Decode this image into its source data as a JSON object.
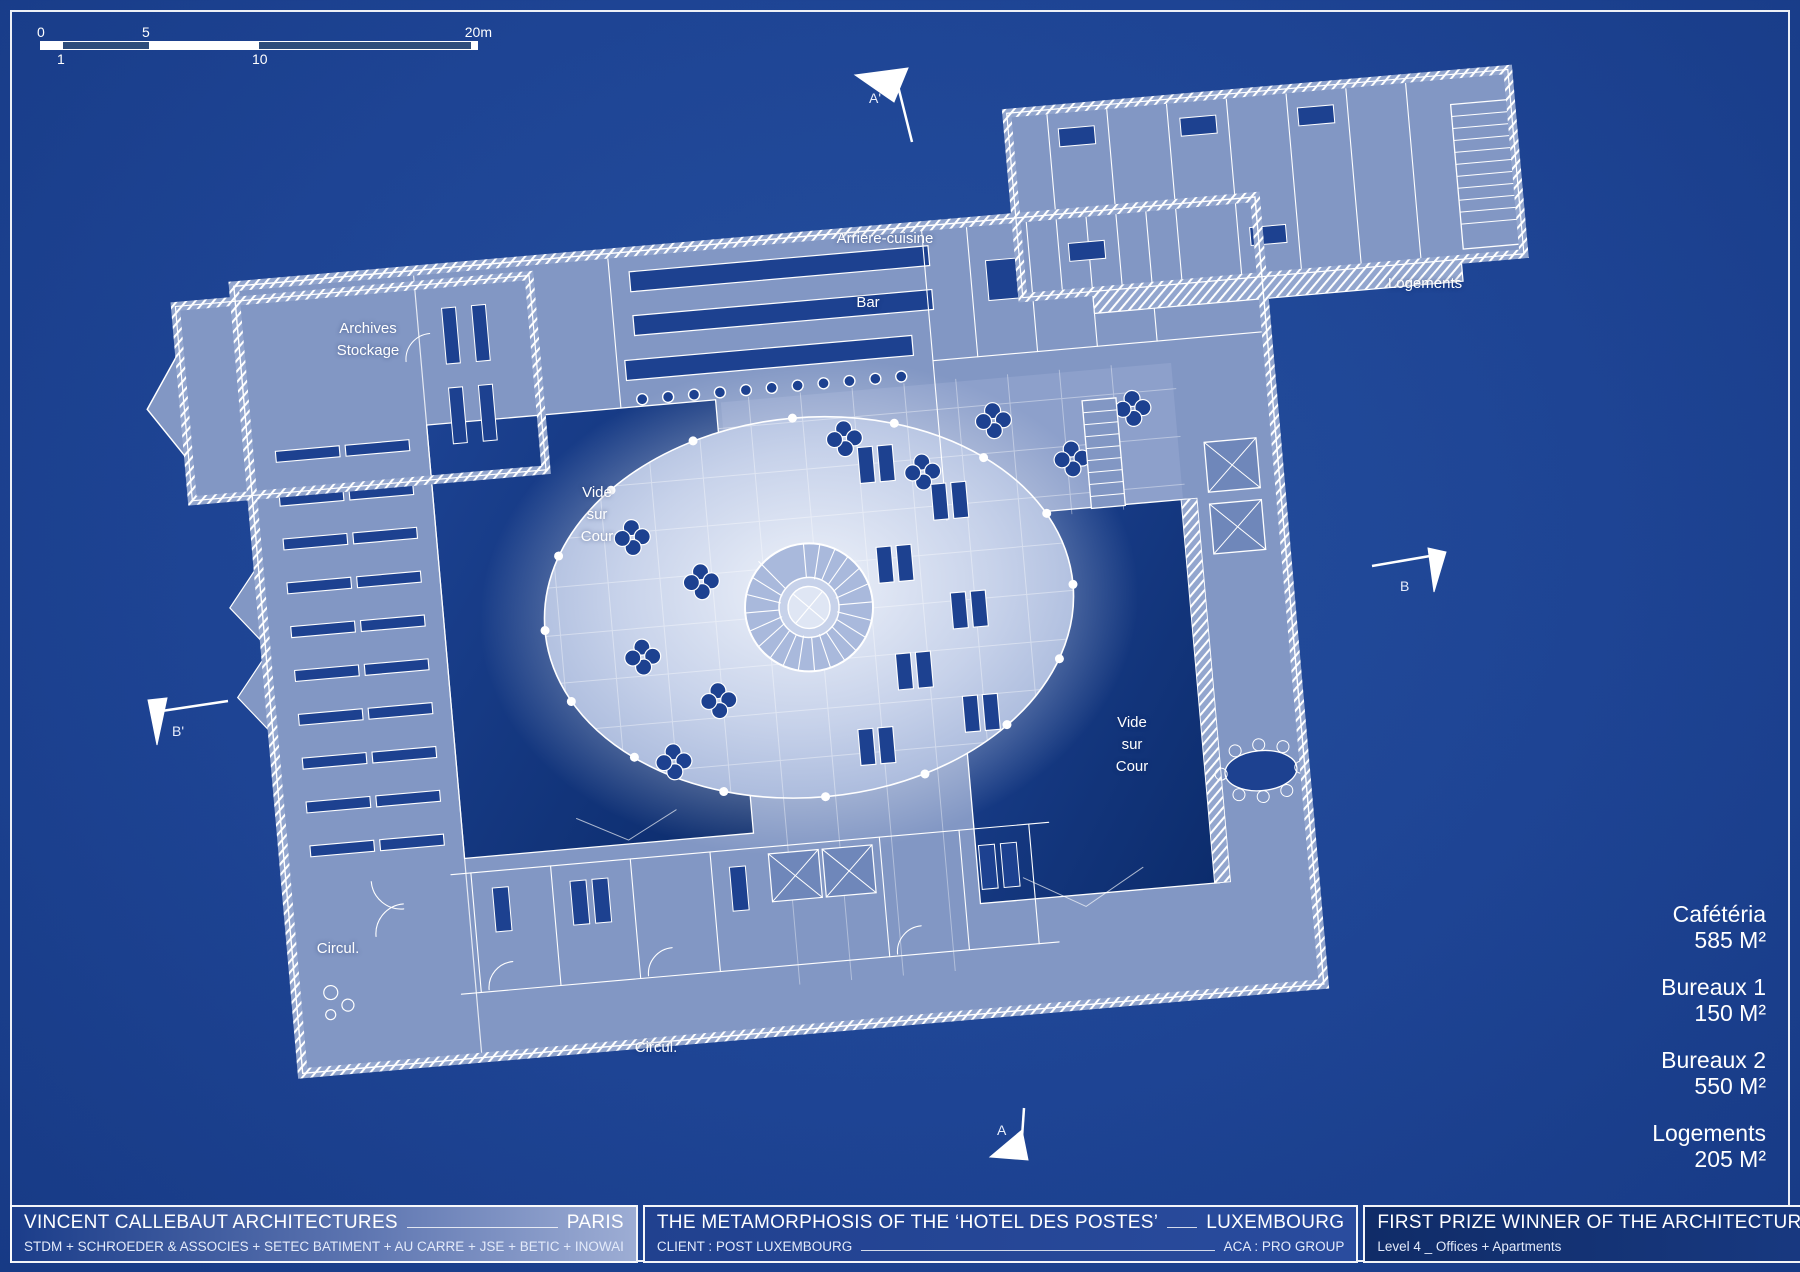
{
  "scale_bar": {
    "top_labels": {
      "zero": "0",
      "five": "5",
      "twenty": "20m"
    },
    "bottom_labels": {
      "one": "1",
      "ten": "10"
    }
  },
  "plan_labels": {
    "arriere_cuisine": "Arriere-cuisine",
    "bar": "Bar",
    "logements": "Logements",
    "archives": "Archives\nStockage",
    "vide_sur_cour_left": "Vide\nsur\nCour",
    "vide_sur_cour_right": "Vide\nsur\nCour",
    "circul_left": "Circul.",
    "circul_bottom": "Circul."
  },
  "section_markers": {
    "a_prime": "A'",
    "b": "B",
    "b_prime": "B'",
    "a": "A"
  },
  "legend": {
    "items": [
      {
        "label": "Cafétéria",
        "area": "585 M²"
      },
      {
        "label": "Bureaux 1",
        "area": "150 M²"
      },
      {
        "label": "Bureaux 2",
        "area": "550 M²"
      },
      {
        "label": "Logements",
        "area": "205 M²"
      }
    ]
  },
  "title_block": {
    "architect": {
      "line1_left": "VINCENT CALLEBAUT ARCHITECTURES",
      "line1_right": "PARIS",
      "line2": "STDM + SCHROEDER & ASSOCIES + SETEC BATIMENT + AU CARRE + JSE + BETIC + INOWAI"
    },
    "project": {
      "line1_left": "THE METAMORPHOSIS OF THE ‘HOTEL DES POSTES’",
      "line1_right": "LUXEMBOURG",
      "line2_left": "CLIENT : POST LUXEMBOURG",
      "line2_right": "ACA : PRO GROUP"
    },
    "award": {
      "line1": "FIRST PRIZE WINNER OF THE ARCHITECTURAL COMPETITION _ 2015-2018",
      "line2": "Level 4 _ Offices + Apartments"
    }
  },
  "colors": {
    "background": "#1e4494",
    "floor": "#8297c4",
    "courtyard_dark": "#0e2f72",
    "furniture": "#1d4190",
    "line": "#ffffff"
  }
}
